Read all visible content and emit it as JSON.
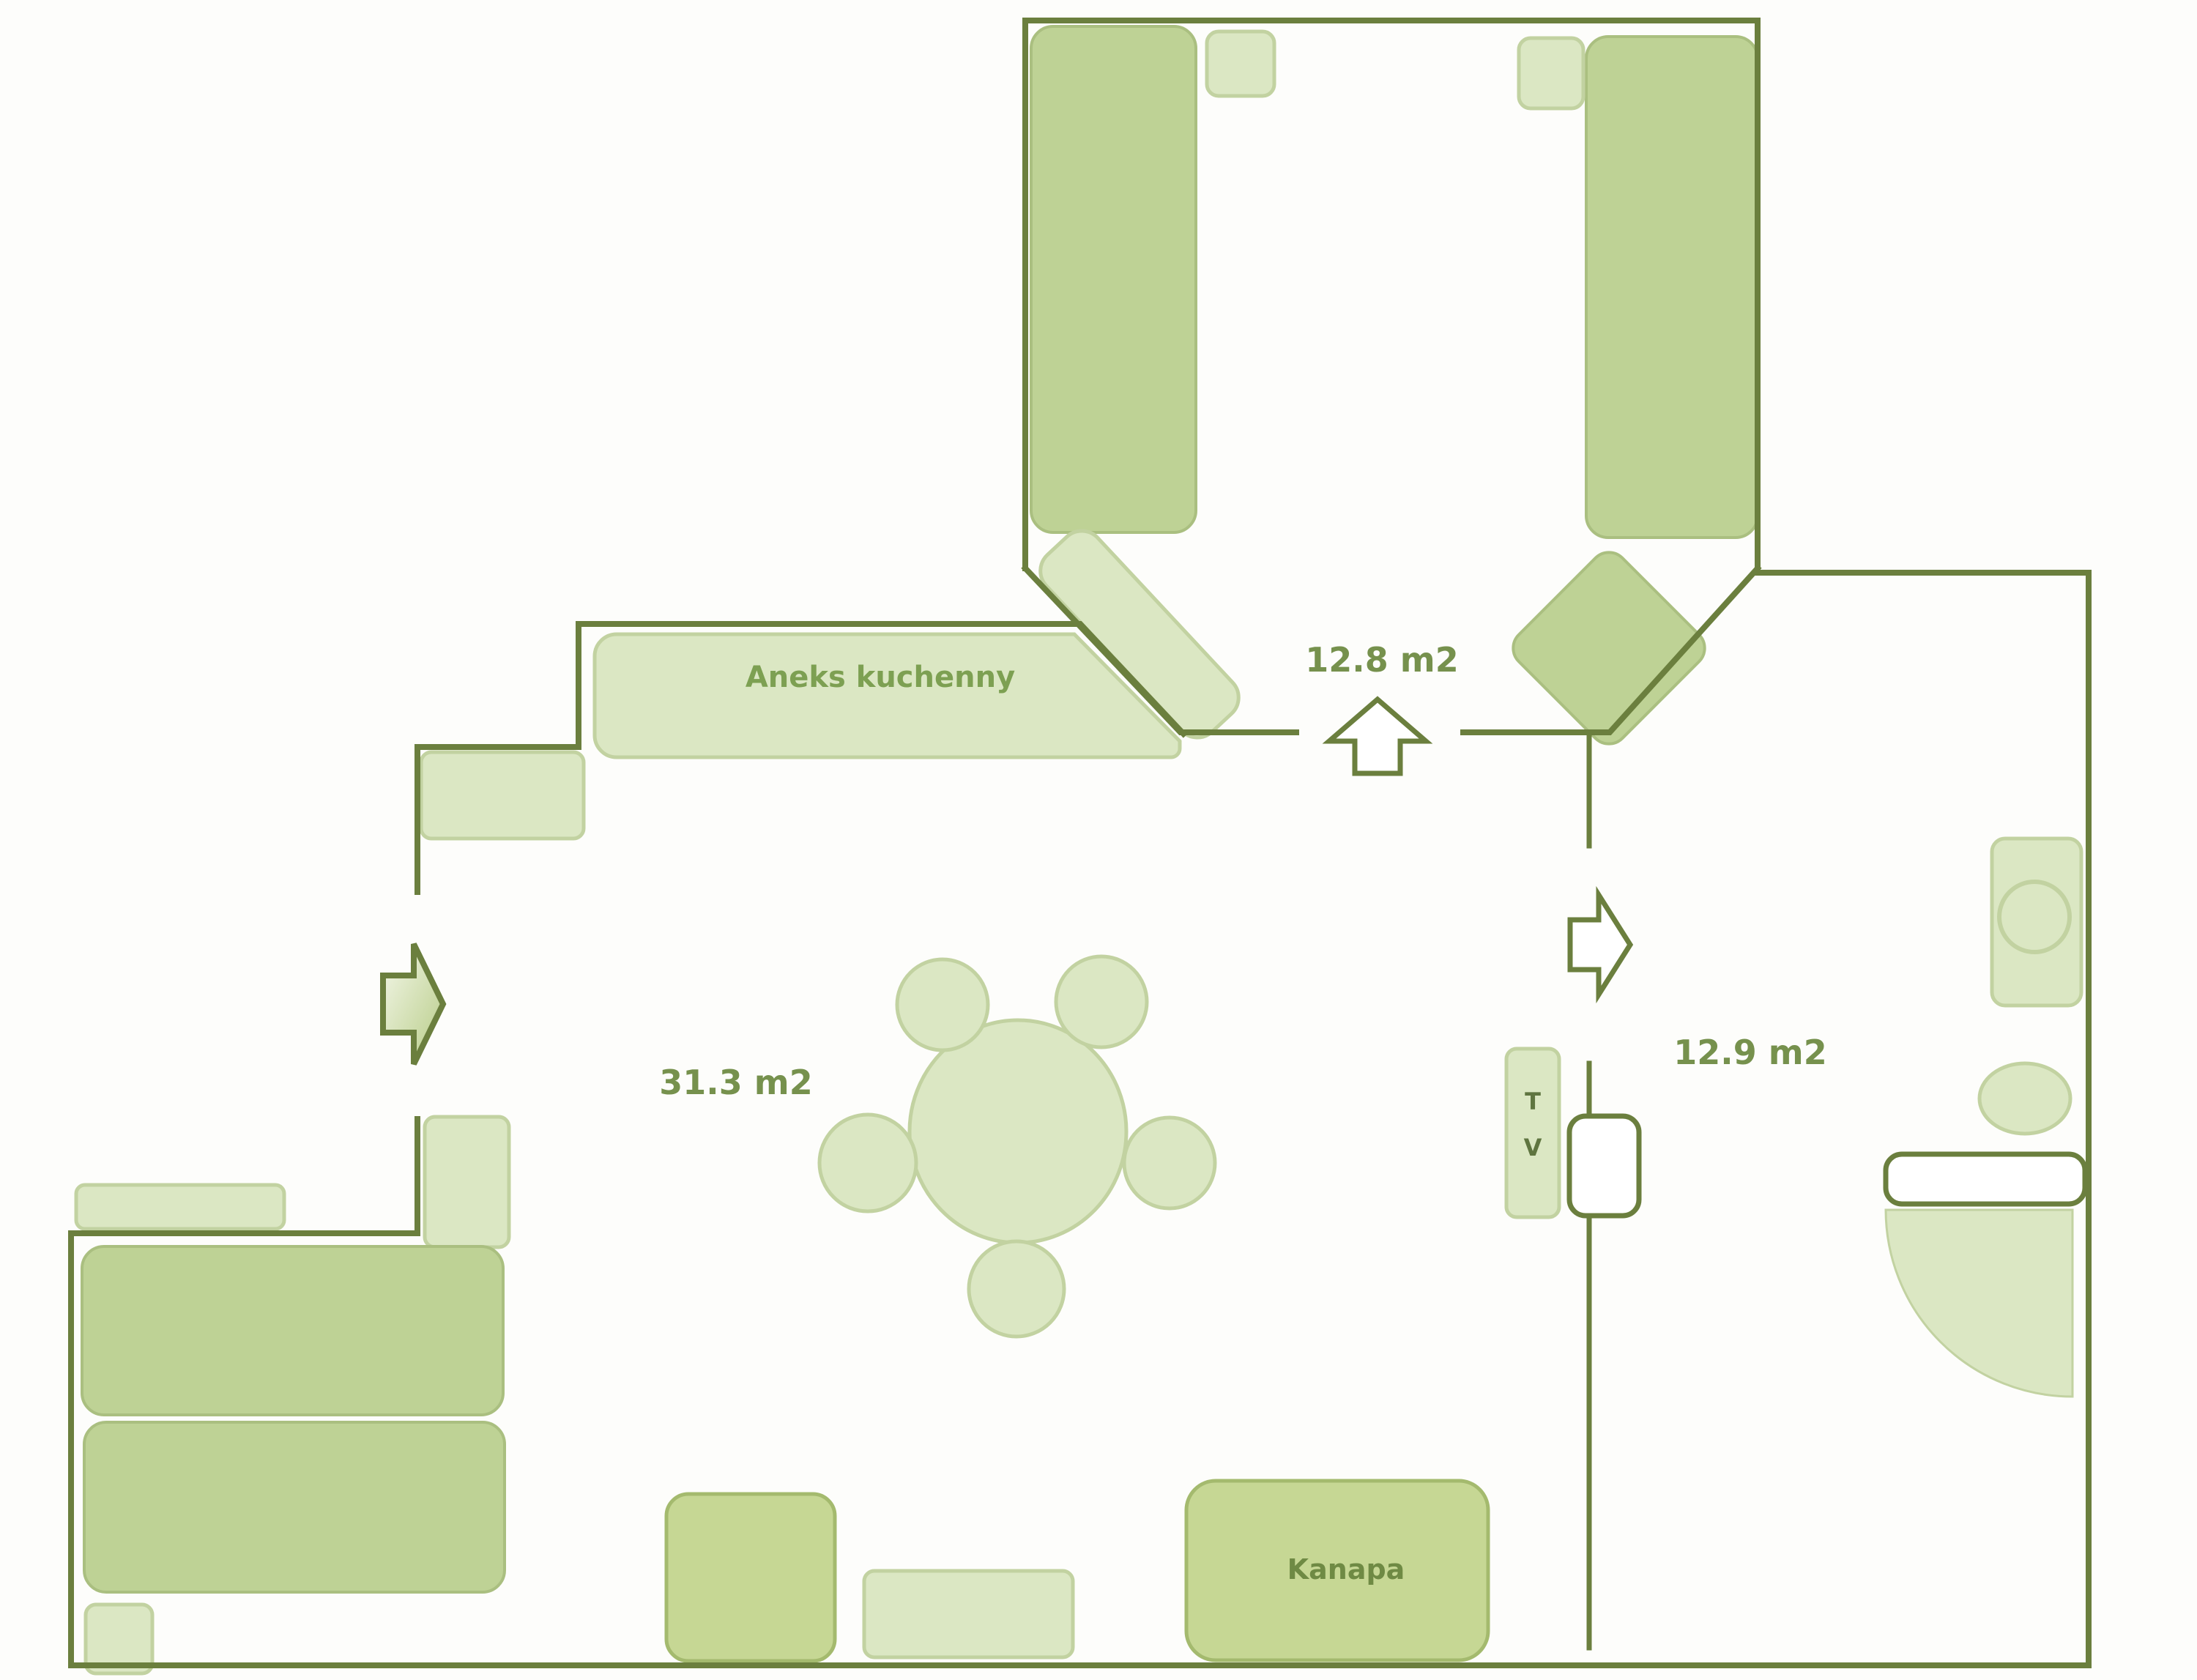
{
  "plan": {
    "rooms": [
      {
        "id": "bedroom",
        "area_label": "12.8 m2"
      },
      {
        "id": "living-room",
        "area_label": "31.3 m2"
      },
      {
        "id": "right-room",
        "area_label": "12.9 m2"
      }
    ],
    "furniture_labels": {
      "kitchen": "Aneks kuchenny",
      "sofa": "Kanapa",
      "tv": [
        "T",
        "V"
      ]
    }
  },
  "colors": {
    "background": "#fdfdfb",
    "wall": "#6b7f3e",
    "furniture": "#bed295",
    "furniture_border": "#aabf80",
    "sofa": "#c6d794",
    "sofa_border": "#a4ba6e",
    "light": "#dbe7c3",
    "light_border": "#c2d2a1",
    "door_leaf": "#ffffff",
    "label": "#76914d",
    "label_kitchen": "#7da052",
    "label_sofa": "#6f8a44",
    "label_dark": "#5f7540",
    "arrow_gradient_start": "#f4f7ea",
    "arrow_gradient_end": "#b7cc86"
  }
}
